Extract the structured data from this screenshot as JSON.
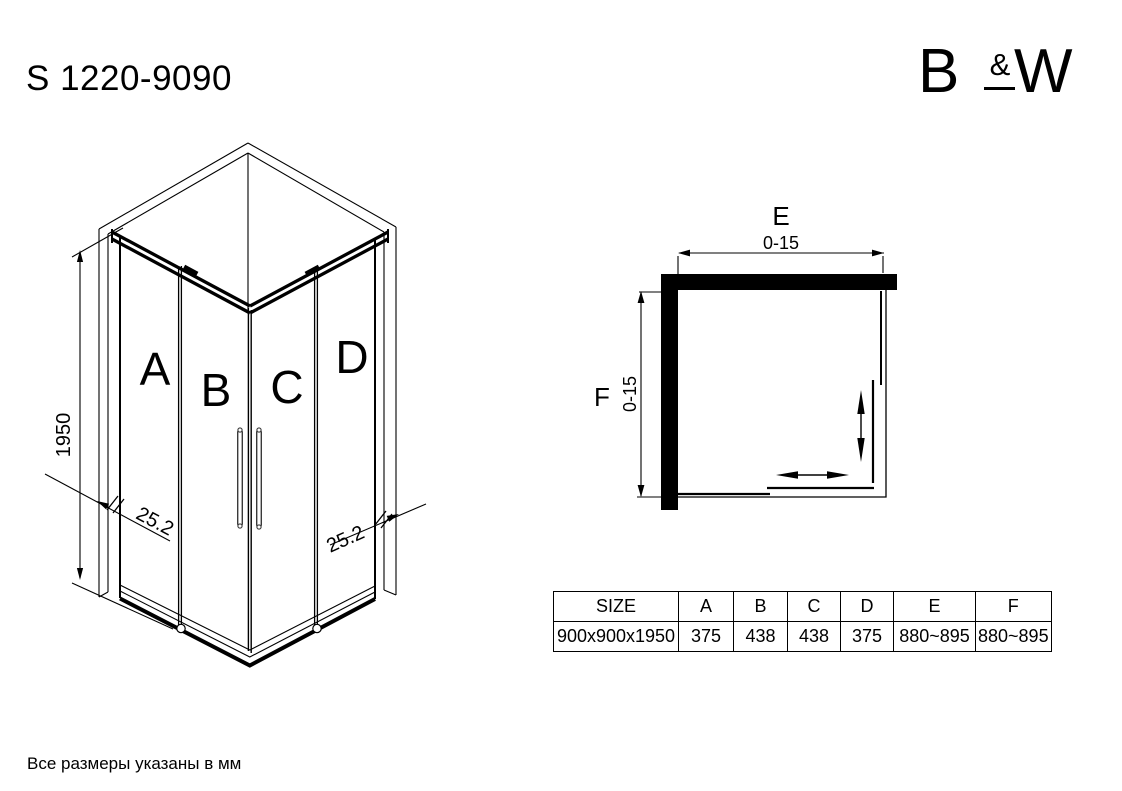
{
  "title": "S 1220-9090",
  "logo": {
    "letter_b": "B",
    "ampersand": "&",
    "letter_w": "W"
  },
  "footnote": "Все размеры указаны в мм",
  "iso_view": {
    "labels": {
      "a": "A",
      "b": "B",
      "c": "C",
      "d": "D"
    },
    "height": "1950",
    "profile_left": "25.2",
    "profile_right": "25.2"
  },
  "plan_view": {
    "e_label": "E",
    "e_value": "0-15",
    "f_label": "F",
    "f_value": "0-15"
  },
  "table": {
    "headers": [
      "SIZE",
      "A",
      "B",
      "C",
      "D",
      "E",
      "F"
    ],
    "row": [
      "900x900x1950",
      "375",
      "438",
      "438",
      "375",
      "880~895",
      "880~895"
    ]
  }
}
